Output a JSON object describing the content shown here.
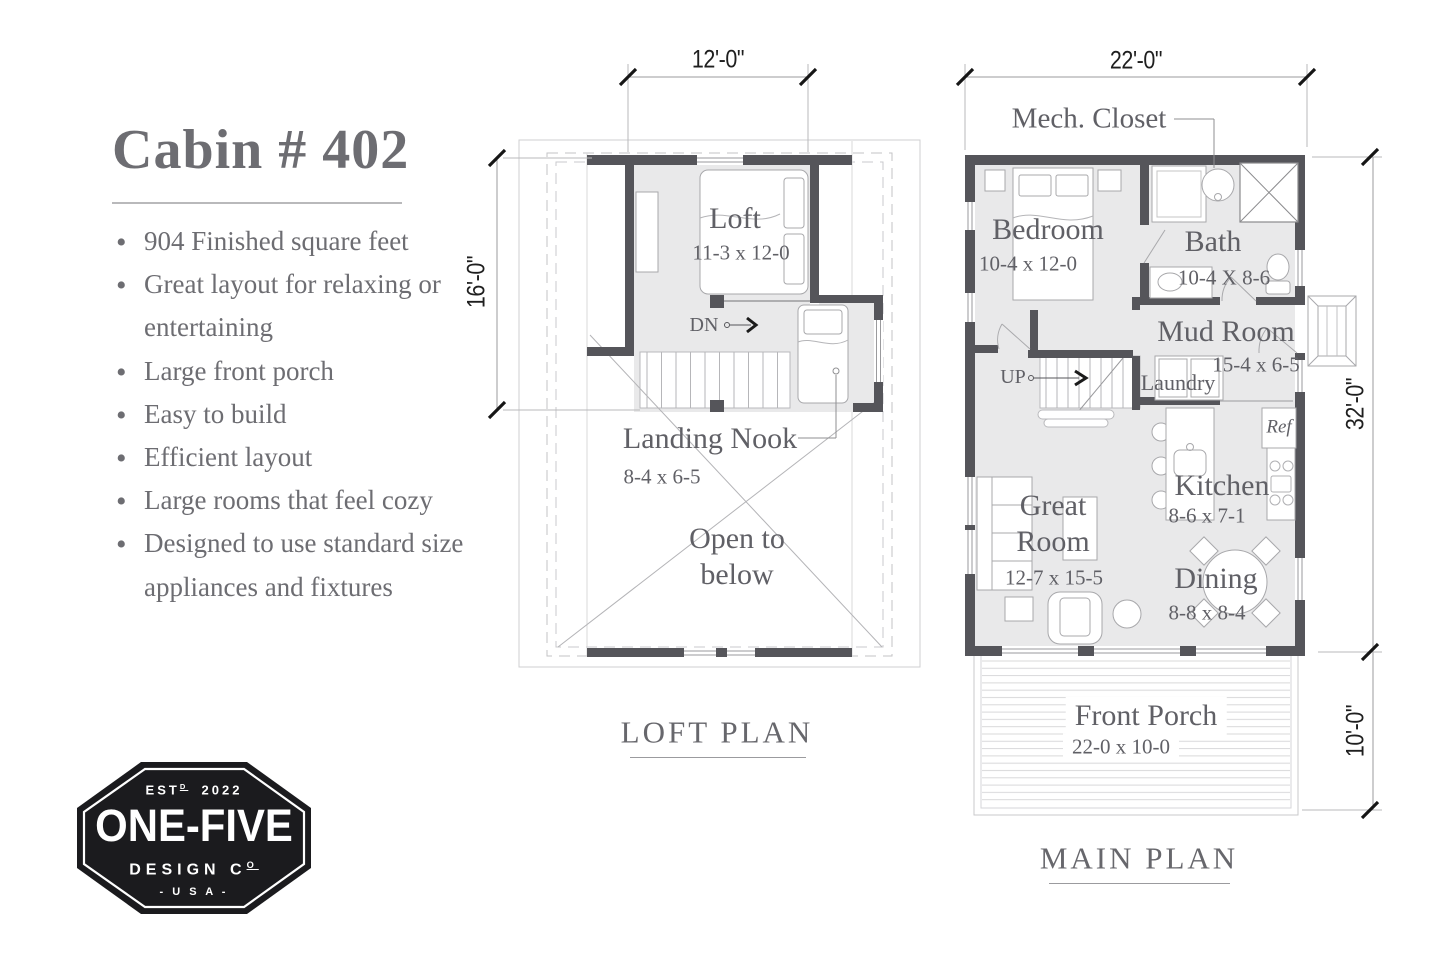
{
  "info_panel": {
    "title": "Cabin # 402",
    "bullets": [
      "904 Finished square feet",
      "Great layout for relaxing or entertaining",
      "Large front porch",
      "Easy to build",
      "Efficient layout",
      "Large rooms that feel cozy",
      "Designed to use standard size appliances and fixtures"
    ]
  },
  "logo": {
    "est_prefix": "EST",
    "est_sup": "D",
    "est_year": "2022",
    "name": "ONE-FIVE",
    "design_prefix": "DESIGN C",
    "design_sup": "O",
    "usa": "- U S A -"
  },
  "loft_plan": {
    "title": "LOFT PLAN",
    "dim_width": "12'-0\"",
    "dim_height": "16'-0\"",
    "rooms": {
      "loft_name": "Loft",
      "loft_size": "11-3 x 12-0",
      "dn": "DN",
      "landing_name": "Landing Nook",
      "landing_size": "8-4 x 6-5",
      "open_below": "Open to below"
    }
  },
  "main_plan": {
    "title": "MAIN PLAN",
    "dim_width": "22'-0\"",
    "dim_height": "32'-0\"",
    "dim_porch": "10'-0\"",
    "mech_closet": "Mech. Closet",
    "rooms": {
      "bedroom_name": "Bedroom",
      "bedroom_size": "10-4 x 12-0",
      "bath_name": "Bath",
      "bath_size": "10-4 X 8-6",
      "mud_name": "Mud Room",
      "mud_size": "15-4 x 6-5",
      "laundry": "Laundry",
      "up": "UP",
      "ref": "Ref",
      "kitchen_name": "Kitchen",
      "kitchen_size": "8-6 x 7-1",
      "great_name": "Great Room",
      "great_size": "12-7 x 15-5",
      "dining_name": "Dining",
      "dining_size": "8-8 x 8-4",
      "porch_name": "Front Porch",
      "porch_size": "22-0 x 10-0"
    }
  },
  "colors": {
    "wall": "#55555a",
    "floor": "#e9e9ea",
    "label_text": "#606066",
    "dim_text": "#1f1f1f",
    "logo_bg": "#1b1b1e"
  }
}
